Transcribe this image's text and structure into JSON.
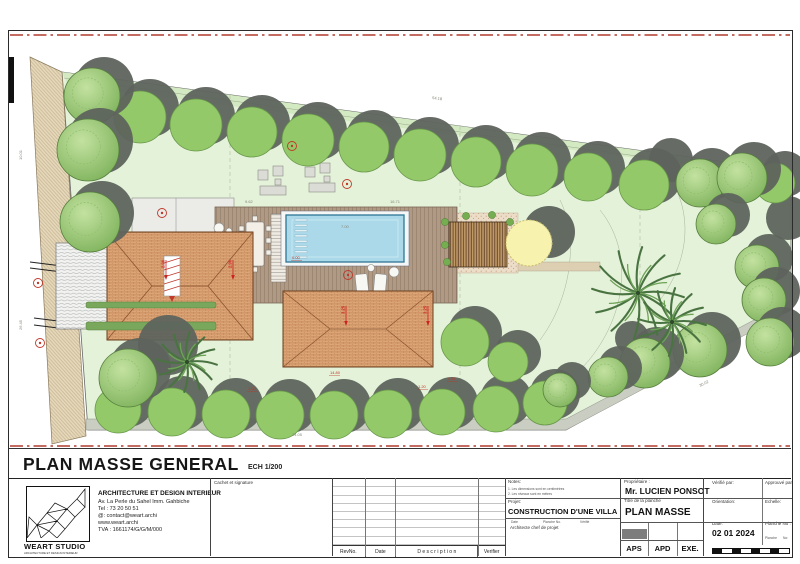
{
  "sheet": {
    "title": "PLAN MASSE GENERAL",
    "scale_note": "ECH 1/200"
  },
  "titleblock": {
    "company": {
      "logo_title": "WEART STUDIO",
      "logo_subtitle": "ARCHITECTURE ET DESIGN INTERIEUR",
      "heading": "ARCHITECTURE ET DESIGN INTERIEUR",
      "address": "Av. La Perle du Sahel Imm. Gahbiche",
      "tel": "Tel : 73 20 50 51",
      "email": "@: contact@weart.archi",
      "website": "www.weart.archi",
      "tva": "TVA : 1661174/G/G/M/000"
    },
    "cachet_label": "Cachet et signature",
    "revision": {
      "headers": [
        "RevNo.",
        "Date",
        "D e s c r i p t i o n",
        "Verifier"
      ]
    },
    "notes": {
      "label": "Notes:",
      "lines": [
        "1. Les dimensions sont en centimètres",
        "2. Les niveaux sont en mètres"
      ]
    },
    "projet": {
      "label": "Projet:",
      "value": "CONSTRUCTION D'UNE VILLA",
      "sub_headers": [
        "Date",
        "Planche No.",
        "Vérifié"
      ],
      "sub": "Architecte chef de projet"
    },
    "proprietaire": {
      "label": "Propriétaire :",
      "value": "Mr. LUCIEN PONSOT"
    },
    "planche": {
      "label": "Titre de la planche",
      "value": "PLAN MASSE"
    },
    "verifie_label": "Vérifié par:",
    "approuve_label": "Approuvé par:",
    "orientation_label": "Orientation:",
    "echelle_label": "Echelle:",
    "date_label": "Date:",
    "date_value": "02 01 2024",
    "planche_no_label": "Planche No :",
    "planche_word": "Planche",
    "no_word": "No:",
    "phases": [
      "APS",
      "APD",
      "EXE."
    ]
  },
  "plan": {
    "colors": {
      "lawn": "#e4f2d9",
      "roof": "#dfab7e",
      "pool": "#abd9e9",
      "red": "#c0392b",
      "tree": "#93c969",
      "shadow": "#5e645d",
      "yellow_tree": "#f7f2ae"
    },
    "dims": [
      [
        432,
        99,
        "54.18",
        7.5
      ],
      [
        292,
        436,
        "24.05",
        0
      ],
      [
        700,
        387,
        "30.02",
        -27
      ],
      [
        22,
        160,
        "10.01",
        -90
      ],
      [
        22,
        330,
        "26.45",
        -90
      ],
      [
        245,
        203,
        "9.62",
        0
      ],
      [
        341,
        228,
        "7.00",
        0
      ],
      [
        390,
        203,
        "16.71",
        0
      ]
    ],
    "levels": [
      [
        330,
        374,
        "14.80"
      ],
      [
        248,
        390,
        "3.60"
      ],
      [
        418,
        388,
        "1.20"
      ],
      [
        448,
        380,
        "0.45"
      ],
      [
        292,
        259,
        "0.00"
      ]
    ],
    "roofdims": [
      [
        166,
        272,
        "2.90"
      ],
      [
        233,
        272,
        "2.90"
      ],
      [
        346,
        318,
        "3.25"
      ],
      [
        428,
        318,
        "3.25"
      ]
    ],
    "badges": [
      [
        347,
        184
      ],
      [
        292,
        146
      ],
      [
        162,
        213
      ],
      [
        348,
        275
      ],
      [
        38,
        283
      ],
      [
        40,
        343
      ]
    ],
    "trees": {
      "plain": [
        [
          140,
          117,
          26
        ],
        [
          196,
          125,
          26
        ],
        [
          252,
          132,
          25
        ],
        [
          308,
          140,
          26
        ],
        [
          364,
          147,
          25
        ],
        [
          420,
          155,
          26
        ],
        [
          476,
          162,
          25
        ],
        [
          532,
          170,
          26
        ],
        [
          588,
          177,
          24
        ],
        [
          644,
          185,
          25
        ],
        [
          118,
          410,
          23
        ],
        [
          172,
          412,
          24
        ],
        [
          226,
          414,
          24
        ],
        [
          280,
          415,
          24
        ],
        [
          334,
          415,
          24
        ],
        [
          388,
          414,
          24
        ],
        [
          442,
          412,
          23
        ],
        [
          496,
          409,
          23
        ],
        [
          545,
          403,
          22
        ],
        [
          465,
          342,
          24
        ],
        [
          508,
          362,
          20
        ],
        [
          775,
          183,
          20
        ]
      ],
      "textured": [
        [
          92,
          96,
          28
        ],
        [
          88,
          150,
          31
        ],
        [
          90,
          222,
          30
        ],
        [
          128,
          378,
          29
        ],
        [
          700,
          183,
          24
        ],
        [
          742,
          178,
          25
        ],
        [
          716,
          224,
          20
        ],
        [
          757,
          267,
          22
        ],
        [
          764,
          300,
          22
        ],
        [
          770,
          342,
          24
        ],
        [
          700,
          350,
          27
        ],
        [
          645,
          363,
          25
        ],
        [
          608,
          377,
          20
        ],
        [
          560,
          390,
          17
        ]
      ],
      "dark": [
        [
          168,
          345,
          30
        ],
        [
          671,
          160,
          22
        ],
        [
          788,
          218,
          22
        ],
        [
          632,
          338,
          17
        ]
      ],
      "palms": [
        [
          187,
          362,
          30
        ],
        [
          638,
          293,
          46
        ],
        [
          672,
          322,
          34
        ]
      ],
      "yellow": {
        "canopy": [
          529,
          243,
          23
        ],
        "shadow": [
          549,
          232,
          26
        ]
      }
    },
    "hedges": [
      [
        86,
        322,
        130,
        8
      ],
      [
        86,
        302,
        130,
        6
      ]
    ],
    "shrubs": [
      [
        445,
        222
      ],
      [
        445,
        245
      ],
      [
        447,
        262
      ],
      [
        510,
        222
      ],
      [
        512,
        247
      ],
      [
        466,
        216
      ],
      [
        492,
        215
      ],
      [
        520,
        235
      ]
    ]
  }
}
